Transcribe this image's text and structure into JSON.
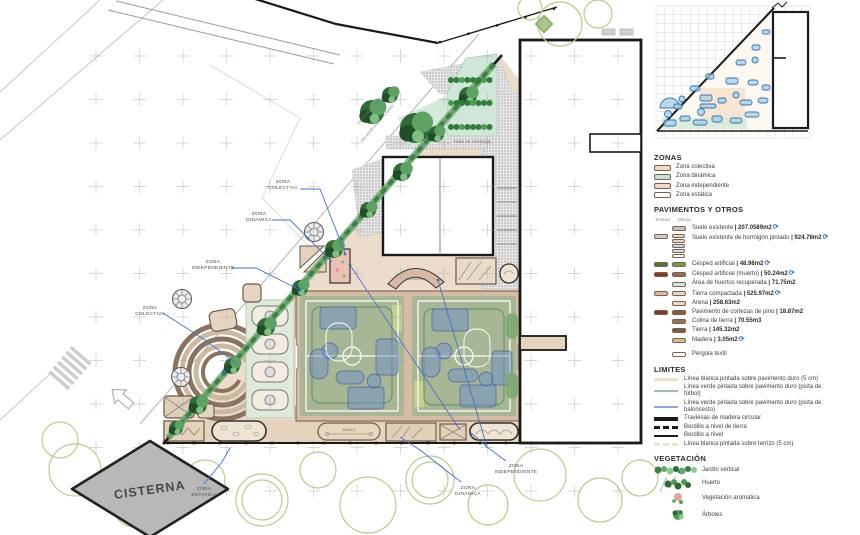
{
  "plan": {
    "words": {
      "zona": "ZONA",
      "colectiva": "COLECTIVA",
      "dinamica": "DINAMICA",
      "independiente": "INDEPENDIENTE",
      "estatica": "ESTATICA"
    },
    "cisterna": "CISTERNA",
    "huertos_label": "ZONA DE HUERTOS",
    "banco_label": "BANCO",
    "rocodromo_label": "ROCODROMO",
    "street_line1": "CALLE DEL MUSEO",
    "street_line2": "SALVADOR GINER PUCHADES",
    "leader_blue": "#4472c4"
  },
  "legend": {
    "icons": {
      "recycle": "⟳"
    },
    "zonas": {
      "title": "ZONAS",
      "items": [
        {
          "label": "Zona colectiva",
          "color": "#f2d9c3"
        },
        {
          "label": "Zona dinámica",
          "color": "#c2e2de"
        },
        {
          "label": "Zona independiente",
          "color": "#f4d6cd"
        },
        {
          "label": "Zona estática",
          "color": "#ffffff"
        }
      ]
    },
    "pavimentos": {
      "title": "PAVIMENTOS Y OTROS",
      "col_textura": "Textura",
      "col_dibujo": "Dibujo",
      "items": [
        {
          "label": "Suelo existente ",
          "value": "| 207.0589m2",
          "recycle": true,
          "colors": [
            "#d8d8d8"
          ]
        },
        {
          "label": "Suelo existente de hormigón pintado ",
          "value": "| 924.78m2",
          "recycle": true,
          "colors": [
            "#c9c9c9",
            "#ecd5bd",
            "#f2d4ca",
            "#ccd9ea",
            "#d2e5d6",
            "#ffffff"
          ]
        },
        {
          "label": "Césped artificial ",
          "value": "| 48.96m2",
          "recycle": true,
          "colors": [
            "#4c7a33",
            "#6f9e4e"
          ]
        },
        {
          "label": "Césped artificial (muerto) ",
          "value": "| 50.24m2",
          "recycle": true,
          "colors": [
            "#8a3a2a",
            "#9a6a4f"
          ]
        },
        {
          "label": "Área de huertos recuperada ",
          "value": "| 71.75m2",
          "recycle": false,
          "colors": [
            "#cfe8da"
          ]
        },
        {
          "label": "Tierra compactada ",
          "value": "| 525.97m2",
          "recycle": true,
          "colors": [
            "#e2b4a2",
            "#ecd6c3"
          ]
        },
        {
          "label": "Arena ",
          "value": "| 258.63m2",
          "recycle": false,
          "colors": [
            "#eadbc4"
          ]
        },
        {
          "label": "Pavimento de cortezas de pino ",
          "value": "| 18.87m2",
          "recycle": false,
          "colors": [
            "#7e3b2b",
            "#8a5a3f"
          ]
        },
        {
          "label": "Colina de tierra ",
          "value": "| 70.55m3",
          "recycle": false,
          "colors": [
            "#9a7357"
          ]
        },
        {
          "label": "Tierra ",
          "value": "| 145.32m2",
          "recycle": false,
          "colors": [
            "#7d5b43"
          ]
        },
        {
          "label": "Madera ",
          "value": "| 3.05m2",
          "recycle": true,
          "colors": [
            "#d9b98f"
          ]
        },
        {
          "label": "Pérgola textil",
          "value": "",
          "recycle": false,
          "colors": [
            "#ffffff"
          ]
        }
      ]
    },
    "limites": {
      "title": "LIMITES",
      "items": [
        {
          "label": "Línea blanca pintada sobre pavimento duro (5 cm)",
          "color": "#e9e2cc"
        },
        {
          "label": "Línea verde pintada sobre pavimento duro (pista de fútbol)",
          "color": "#9dc49a"
        },
        {
          "label": "Línea verde pintada sobre pavimento duro (pista de baloncesto)",
          "color": "#8fa5d8"
        },
        {
          "label": "Traviesas de madera circular",
          "color": "#1a1a1a"
        },
        {
          "label": "Bordillo a nivel de tierra",
          "color": "#1a1a1a"
        },
        {
          "label": "Bordillo a nivel",
          "color": "#1a1a1a"
        },
        {
          "label": "Línea blanca pintada sobre terrizo (5 cm)",
          "color": "#e9e2cc"
        }
      ]
    },
    "vegetacion": {
      "title": "VEGETACIÓN",
      "items": [
        {
          "label": "Jardín vertical"
        },
        {
          "label": "Huerto"
        },
        {
          "label": "Vegetación aromática"
        },
        {
          "label": "Árboles"
        }
      ]
    }
  }
}
